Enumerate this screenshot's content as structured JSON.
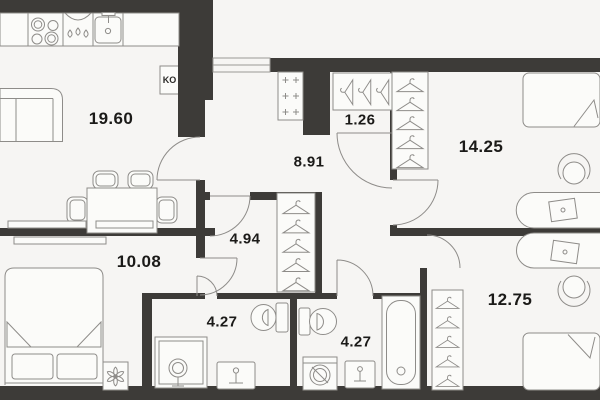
{
  "plan": {
    "type": "apartment-floor-plan",
    "colors": {
      "wall": "#3d3b38",
      "floor": "#f6f5f3",
      "furniture_stroke": "#8e8c89",
      "furniture_fill": "#fbfbf9",
      "label": "#1b1a18"
    },
    "boiler_label": "KO",
    "rooms": [
      {
        "name": "living-kitchen",
        "area": "19.60",
        "x": 111,
        "y": 119,
        "size": 17
      },
      {
        "name": "hallway",
        "area": "8.91",
        "x": 309,
        "y": 162,
        "size": 15
      },
      {
        "name": "closet",
        "area": "1.26",
        "x": 360,
        "y": 120,
        "size": 15
      },
      {
        "name": "bedroom-top-right",
        "area": "14.25",
        "x": 481,
        "y": 147,
        "size": 17
      },
      {
        "name": "corridor",
        "area": "4.94",
        "x": 245,
        "y": 239,
        "size": 15
      },
      {
        "name": "bedroom-left",
        "area": "10.08",
        "x": 139,
        "y": 262,
        "size": 17
      },
      {
        "name": "bathroom-shower",
        "area": "4.27",
        "x": 222,
        "y": 322,
        "size": 15
      },
      {
        "name": "bathroom-tub",
        "area": "4.27",
        "x": 356,
        "y": 342,
        "size": 15
      },
      {
        "name": "bedroom-bottom-right",
        "area": "12.75",
        "x": 510,
        "y": 300,
        "size": 17
      }
    ]
  }
}
